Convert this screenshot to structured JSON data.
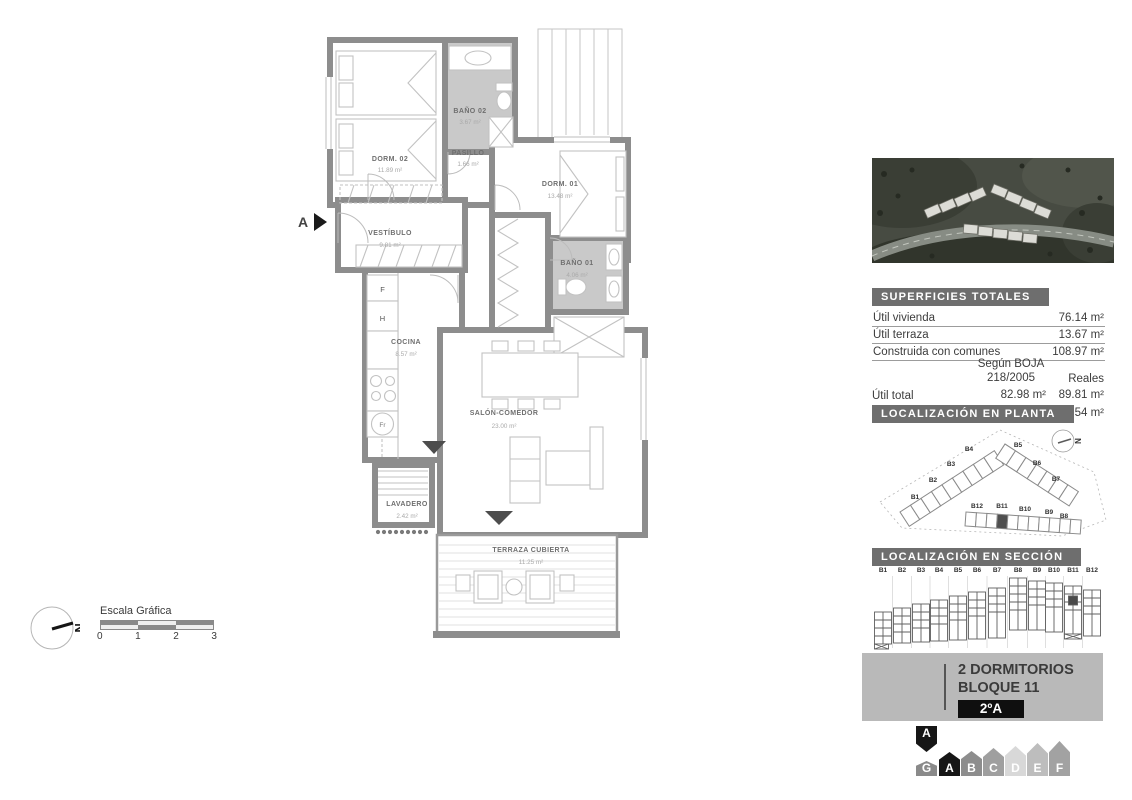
{
  "plan": {
    "section_marker": "A",
    "rooms": [
      {
        "name": "DORM. 02",
        "area": "11.89 m²"
      },
      {
        "name": "BAÑO 02",
        "area": "3.67 m²"
      },
      {
        "name": "PASILLO",
        "area": "1.66 m²"
      },
      {
        "name": "DORM. 01",
        "area": "13.48 m²"
      },
      {
        "name": "VESTÍBULO",
        "area": "9.81 m²"
      },
      {
        "name": "BAÑO 01",
        "area": "4.06 m²"
      },
      {
        "name": "COCINA",
        "area": "8.57 m²"
      },
      {
        "name": "SALÓN-COMEDOR",
        "area": "23.00 m²"
      },
      {
        "name": "LAVADERO",
        "area": "2.42 m²"
      },
      {
        "name": "TERRAZA CUBIERTA",
        "area": "11.25 m²"
      }
    ],
    "appliances": {
      "fridge": "F",
      "oven": "H",
      "fr": "Fr"
    }
  },
  "scale_bar": {
    "title": "Escala Gráfica",
    "ticks": [
      "0",
      "1",
      "2",
      "3"
    ],
    "north": "N"
  },
  "sidebar": {
    "superficies": {
      "title": "SUPERFICIES TOTALES",
      "rows": [
        {
          "label": "Útil vivienda",
          "value": "76.14 m²"
        },
        {
          "label": "Útil terraza",
          "value": "13.67 m²"
        },
        {
          "label": "Construida con comunes",
          "value": "108.97 m²"
        }
      ],
      "col_boja_1": "Según BOJA",
      "col_boja_2": "218/2005",
      "col_reales": "Reales",
      "rows2": [
        {
          "label": "Útil total",
          "boja": "82.98 m²",
          "reales": "89.81 m²"
        },
        {
          "label": "Construida total",
          "boja": "117.26 m²",
          "reales": "125.54 m²"
        }
      ]
    },
    "planta": {
      "title": "LOCALIZACIÓN EN PLANTA",
      "north": "N",
      "labels": [
        "B1",
        "B2",
        "B3",
        "B4",
        "B5",
        "B6",
        "B7",
        "B8",
        "B9",
        "B10",
        "B11",
        "B12"
      ],
      "highlight": "B11"
    },
    "seccion": {
      "title": "LOCALIZACIÓN EN SECCIÓN",
      "columns": [
        "B1",
        "B2",
        "B3",
        "B4",
        "B5",
        "B6",
        "B7",
        "B8",
        "B9",
        "B10",
        "B11",
        "B12"
      ],
      "highlight": "B11"
    },
    "unit": {
      "line1": "2 DORMITORIOS",
      "line2": "BLOQUE 11",
      "badge": "2ºA"
    },
    "letters": [
      {
        "label": "A",
        "color": "#161616"
      },
      {
        "label": "B",
        "color": "#8d8d8d"
      },
      {
        "label": "C",
        "color": "#9f9f9f"
      },
      {
        "label": "D",
        "color": "#d8d8d8"
      },
      {
        "label": "E",
        "color": "#bdbdbd"
      },
      {
        "label": "F",
        "color": "#a2a2a2"
      },
      {
        "label": "G",
        "color": "#8a8a8a"
      }
    ],
    "selected_letter": "A"
  }
}
